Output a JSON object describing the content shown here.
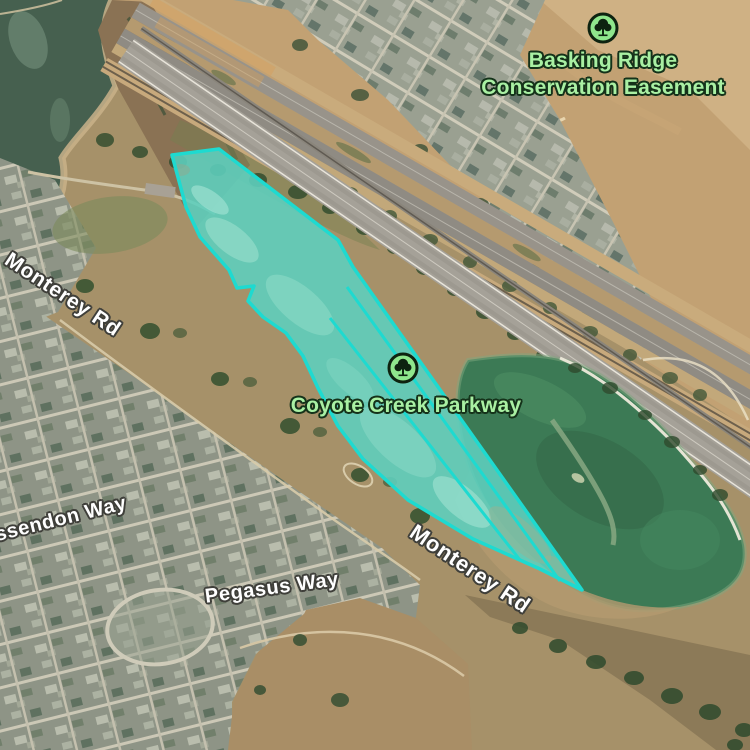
{
  "map": {
    "pois": [
      {
        "label_line1": "Basking Ridge",
        "label_line2": "Conservation Easement",
        "icon": "tree-icon"
      },
      {
        "label": "Coyote Creek Parkway",
        "icon": "tree-icon"
      }
    ],
    "road_labels": [
      {
        "text": "Monterey Rd"
      },
      {
        "text": "Monterey Rd"
      }
    ],
    "street_labels": [
      {
        "text": "ssendon Way"
      },
      {
        "text": "Pegasus Way"
      }
    ],
    "overlay": {
      "stroke": "#1edad0",
      "fill": "rgba(99,232,216,0.30)"
    },
    "colors": {
      "poi_label": "#a9f0a3",
      "poi_halo": "#15321a",
      "road_label": "#ffffff",
      "road_halo": "#3f3f3a"
    }
  }
}
